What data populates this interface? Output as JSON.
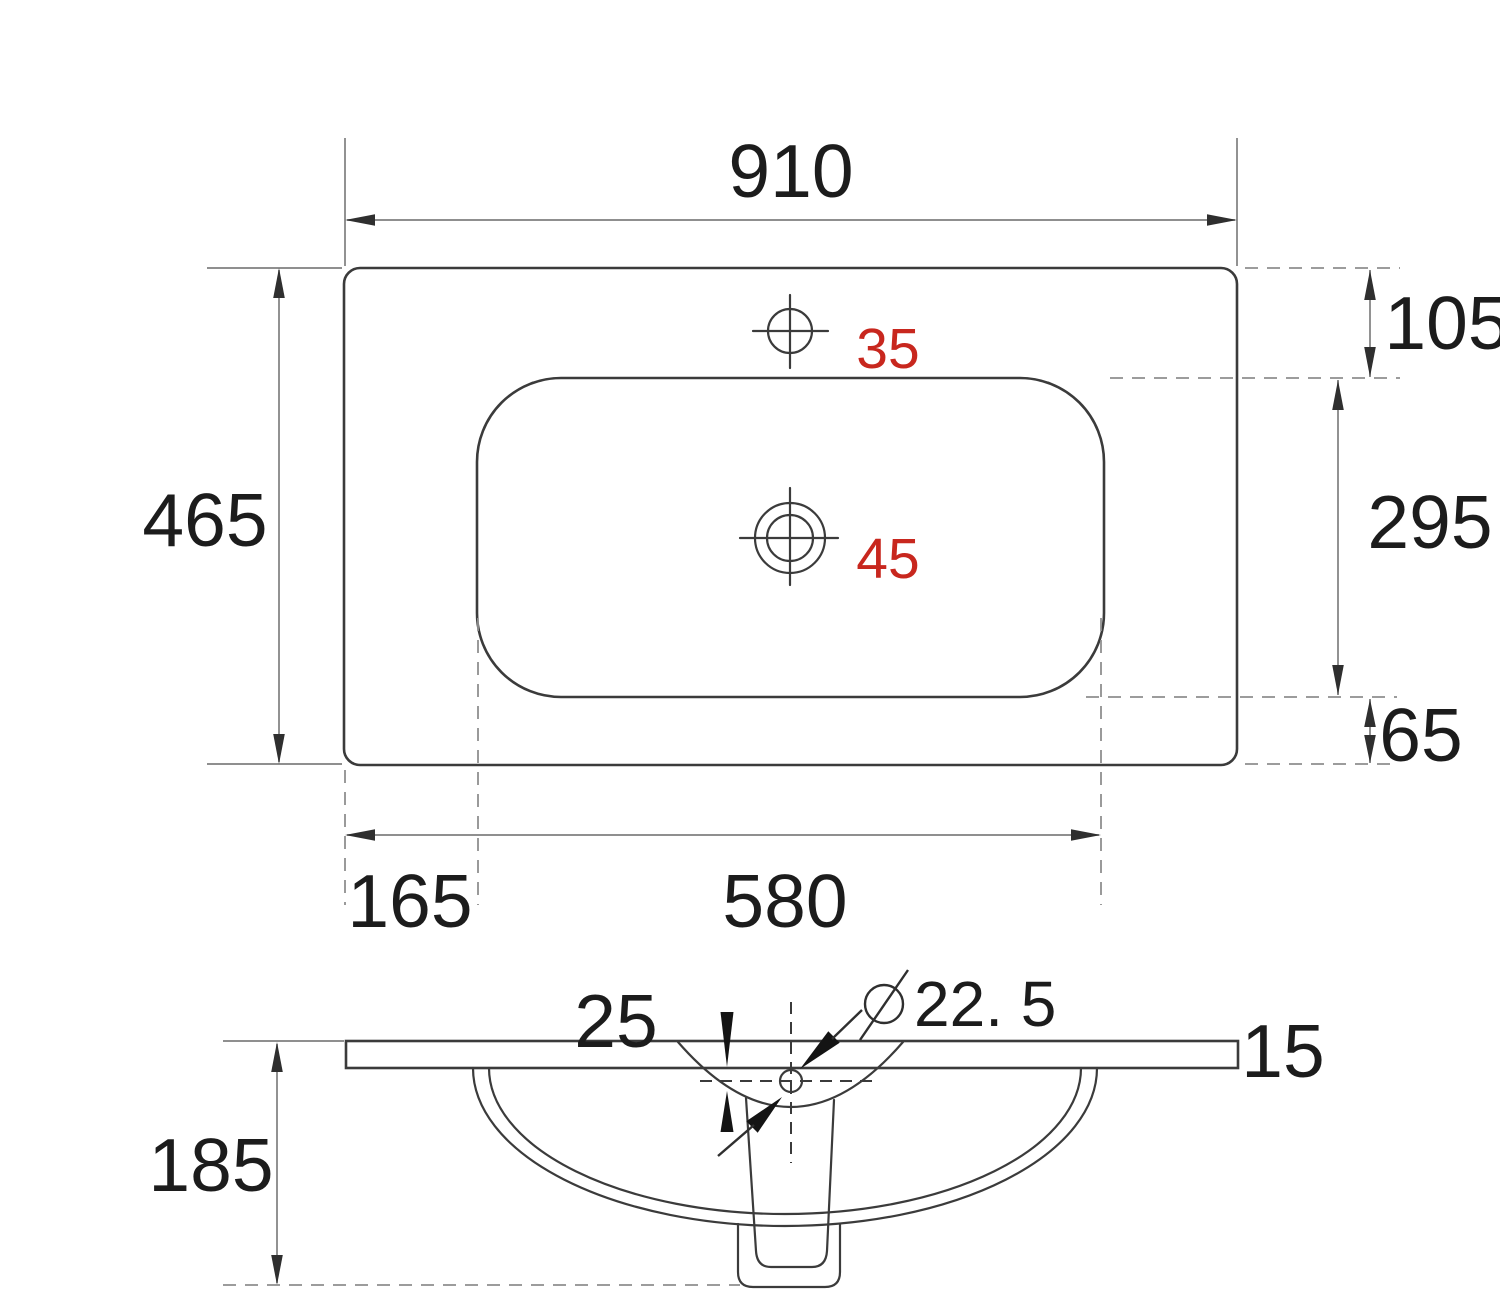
{
  "colors": {
    "background": "#ffffff",
    "outline": "#3b3b3b",
    "dimension_gray": "#7f7f7f",
    "text": "#1c1c1c",
    "accent_red": "#c8271e"
  },
  "top_view": {
    "overall_width": "910",
    "overall_depth": "465",
    "basin_top_offset": "105",
    "basin_depth": "295",
    "basin_bottom_offset": "65",
    "basin_left_offset": "165",
    "basin_width": "580",
    "faucet_hole_diameter": "35",
    "drain_hole_diameter": "45"
  },
  "section_view": {
    "hole_depth": "25",
    "hole_diameter": "22. 5",
    "slab_thickness": "15",
    "overall_height": "185"
  }
}
